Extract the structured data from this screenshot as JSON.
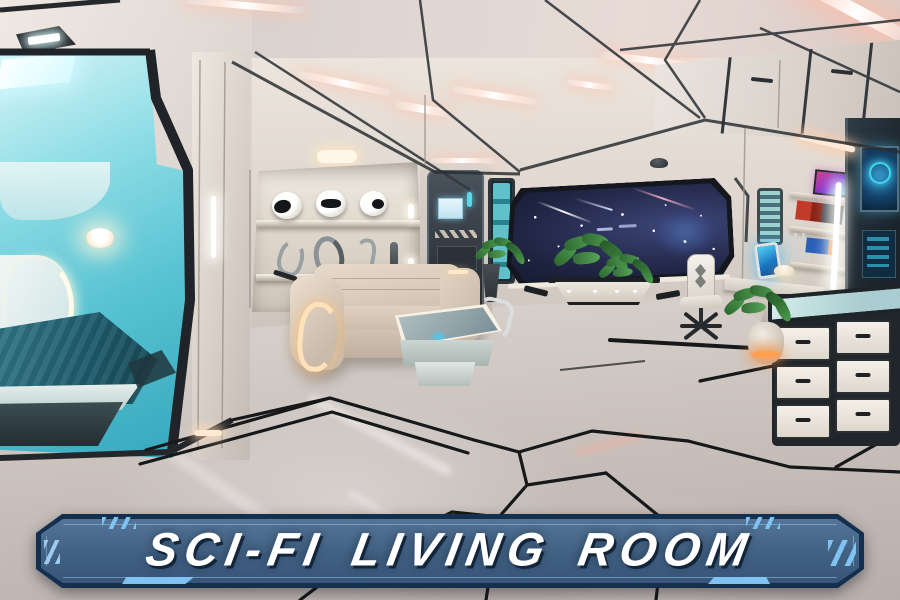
{
  "banner": {
    "title": "SCI-FI LIVING ROOM",
    "colors": {
      "frame": "#14304e",
      "panel": "#416183",
      "accent": "#7fc3f2",
      "text": "#ffffff"
    }
  },
  "scene": {
    "description": "3D rendered futuristic spaceship living-room interior",
    "palette": {
      "pod_teal": "#5fc9d8",
      "ceiling_light_pink": "#ffd9cf",
      "warm_glow": "#ffdfae",
      "space_window_navy": "#232948",
      "floor_gray": "#c7bfba",
      "sofa_beige": "#d9c9b8",
      "floor_line_black": "#17181a",
      "plant_green": "#3e7c3f",
      "screen_blue": "#2fb3e8"
    },
    "objects": [
      "teal sleeping pod with bed and glowing headboard",
      "wall niche with three helmets and four sculptures",
      "sliding door with control screen",
      "tall teal display cabinet",
      "large window onto starfield",
      "planter bench with greenery",
      "cream sofa with glowing armrest",
      "holographic coffee table",
      "white office chair",
      "wall desk with glowing tablet and lamp",
      "wall shelves with books and screens",
      "louvered vent panel",
      "white drawer cabinets",
      "glowing plant pot",
      "pink ceiling light strips"
    ]
  }
}
